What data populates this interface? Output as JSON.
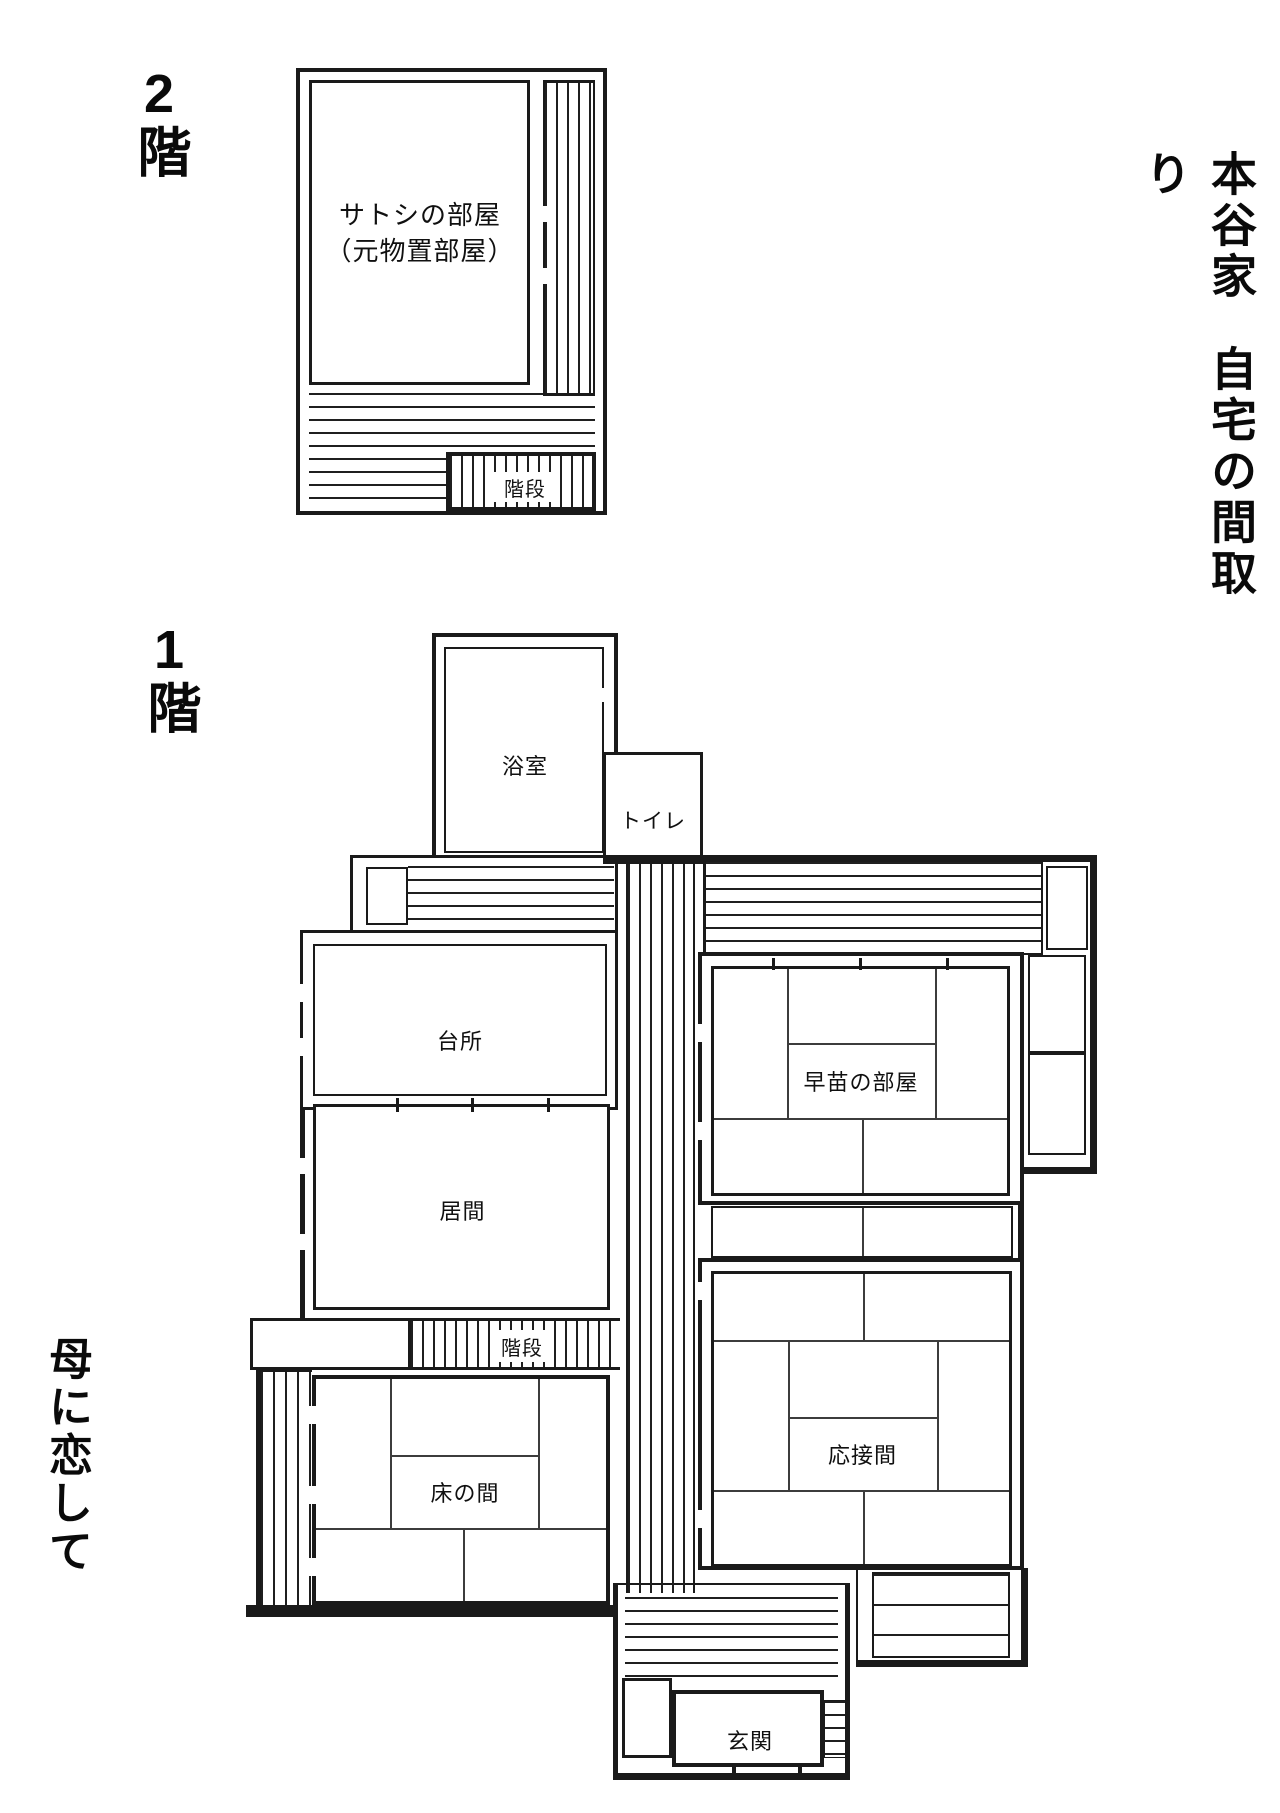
{
  "document": {
    "type": "floor-plan",
    "background": "#ffffff",
    "line_color": "#1a1a1a"
  },
  "titles": {
    "main_part1": "本谷家",
    "main_part2": "自宅の間取り",
    "bottom_title": "母に恋して",
    "floor2_label": "2階",
    "floor1_label": "1階"
  },
  "floor2": {
    "satoshi_line1": "サトシの部屋",
    "satoshi_line2": "（元物置部屋）",
    "stairs_label": "階段"
  },
  "floor1": {
    "bath_label": "浴室",
    "toilet_label": "トイレ",
    "kitchen_label": "台所",
    "living_label": "居間",
    "stairs_label": "階段",
    "tokonoma_label": "床の間",
    "sanae_label": "早苗の部屋",
    "reception_label": "応接間",
    "entrance_label": "玄関"
  }
}
